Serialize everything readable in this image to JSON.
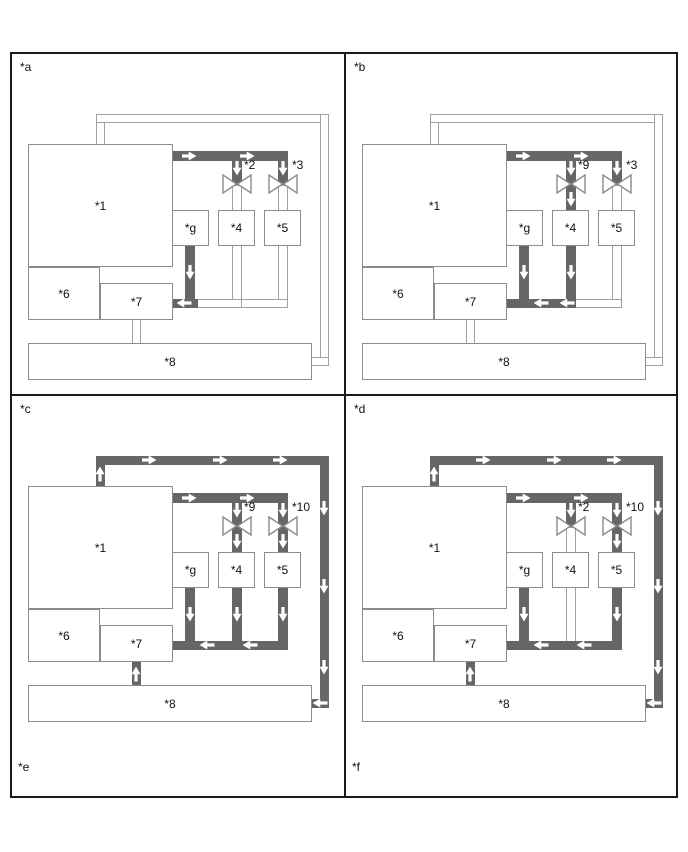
{
  "colors": {
    "background": "#ffffff",
    "frame_border": "#1a1a1a",
    "pipe_active": "#666666",
    "pipe_inactive_border": "#a0a0a0",
    "box_border": "#8c8c8c",
    "valve_stroke": "#8a8a8a",
    "arrow": "#ffffff",
    "text": "#111111"
  },
  "boxes": {
    "b1": "*1",
    "b6": "*6",
    "b7": "*7",
    "b8": "*8",
    "bg": "*g",
    "b4": "*4",
    "b5": "*5"
  },
  "panels": [
    {
      "label": "*a",
      "valve_left_label": "*2",
      "valve_right_label": "*3",
      "footer_label": "",
      "active_pipes": [
        "top_h",
        "vbr_l_hi",
        "vbr_r_hi",
        "g_down",
        "bot_1"
      ],
      "arrows": [
        "top_r1",
        "top_r2",
        "vL_top",
        "vR_top",
        "g_d",
        "bot_l1"
      ]
    },
    {
      "label": "*b",
      "valve_left_label": "*9",
      "valve_right_label": "*3",
      "footer_label": "",
      "active_pipes": [
        "top_h",
        "vbr_l_hi",
        "vbr_l_lo",
        "vbr_r_hi",
        "g_down",
        "p4_down",
        "bot_1",
        "bot_2"
      ],
      "arrows": [
        "top_r1",
        "top_r2",
        "vL_top",
        "vL_bot",
        "vR_top",
        "g_d",
        "p4_d",
        "bot_l2",
        "bot_l3"
      ]
    },
    {
      "label": "*c",
      "valve_left_label": "*9",
      "valve_right_label": "*10",
      "footer_label": "*e",
      "active_pipes": [
        "loop_left_v",
        "loop_top_h",
        "loop_right_v",
        "loop_bot_h",
        "top_h",
        "vbr_l_hi",
        "vbr_l_lo",
        "vbr_r_hi",
        "vbr_r_lo",
        "g_down",
        "p4_down",
        "p5_down",
        "bot_1",
        "bot_2",
        "bot_3",
        "conn78"
      ],
      "arrows": [
        "loop_up",
        "loop_t1",
        "loop_t2",
        "loop_t3",
        "loop_r1",
        "loop_r2",
        "loop_r3",
        "loop_in8",
        "conn_up",
        "top_r1",
        "top_r2",
        "vL_top",
        "vL_bot",
        "vR_top",
        "vR_bot",
        "g_d",
        "p4_d",
        "p5_d",
        "bot_l2",
        "bot_l4"
      ]
    },
    {
      "label": "*d",
      "valve_left_label": "*2",
      "valve_right_label": "*10",
      "footer_label": "*f",
      "active_pipes": [
        "loop_left_v",
        "loop_top_h",
        "loop_right_v",
        "loop_bot_h",
        "top_h",
        "vbr_l_hi",
        "vbr_r_hi",
        "vbr_r_lo",
        "g_down",
        "p5_down",
        "bot_1",
        "bot_2",
        "bot_3",
        "conn78"
      ],
      "arrows": [
        "loop_up",
        "loop_t1",
        "loop_t2",
        "loop_t3",
        "loop_r1",
        "loop_r2",
        "loop_r3",
        "loop_in8",
        "conn_up",
        "top_r1",
        "top_r2",
        "vL_top",
        "vR_top",
        "vR_bot",
        "g_d",
        "p5_d",
        "bot_l2",
        "bot_l4"
      ]
    }
  ]
}
